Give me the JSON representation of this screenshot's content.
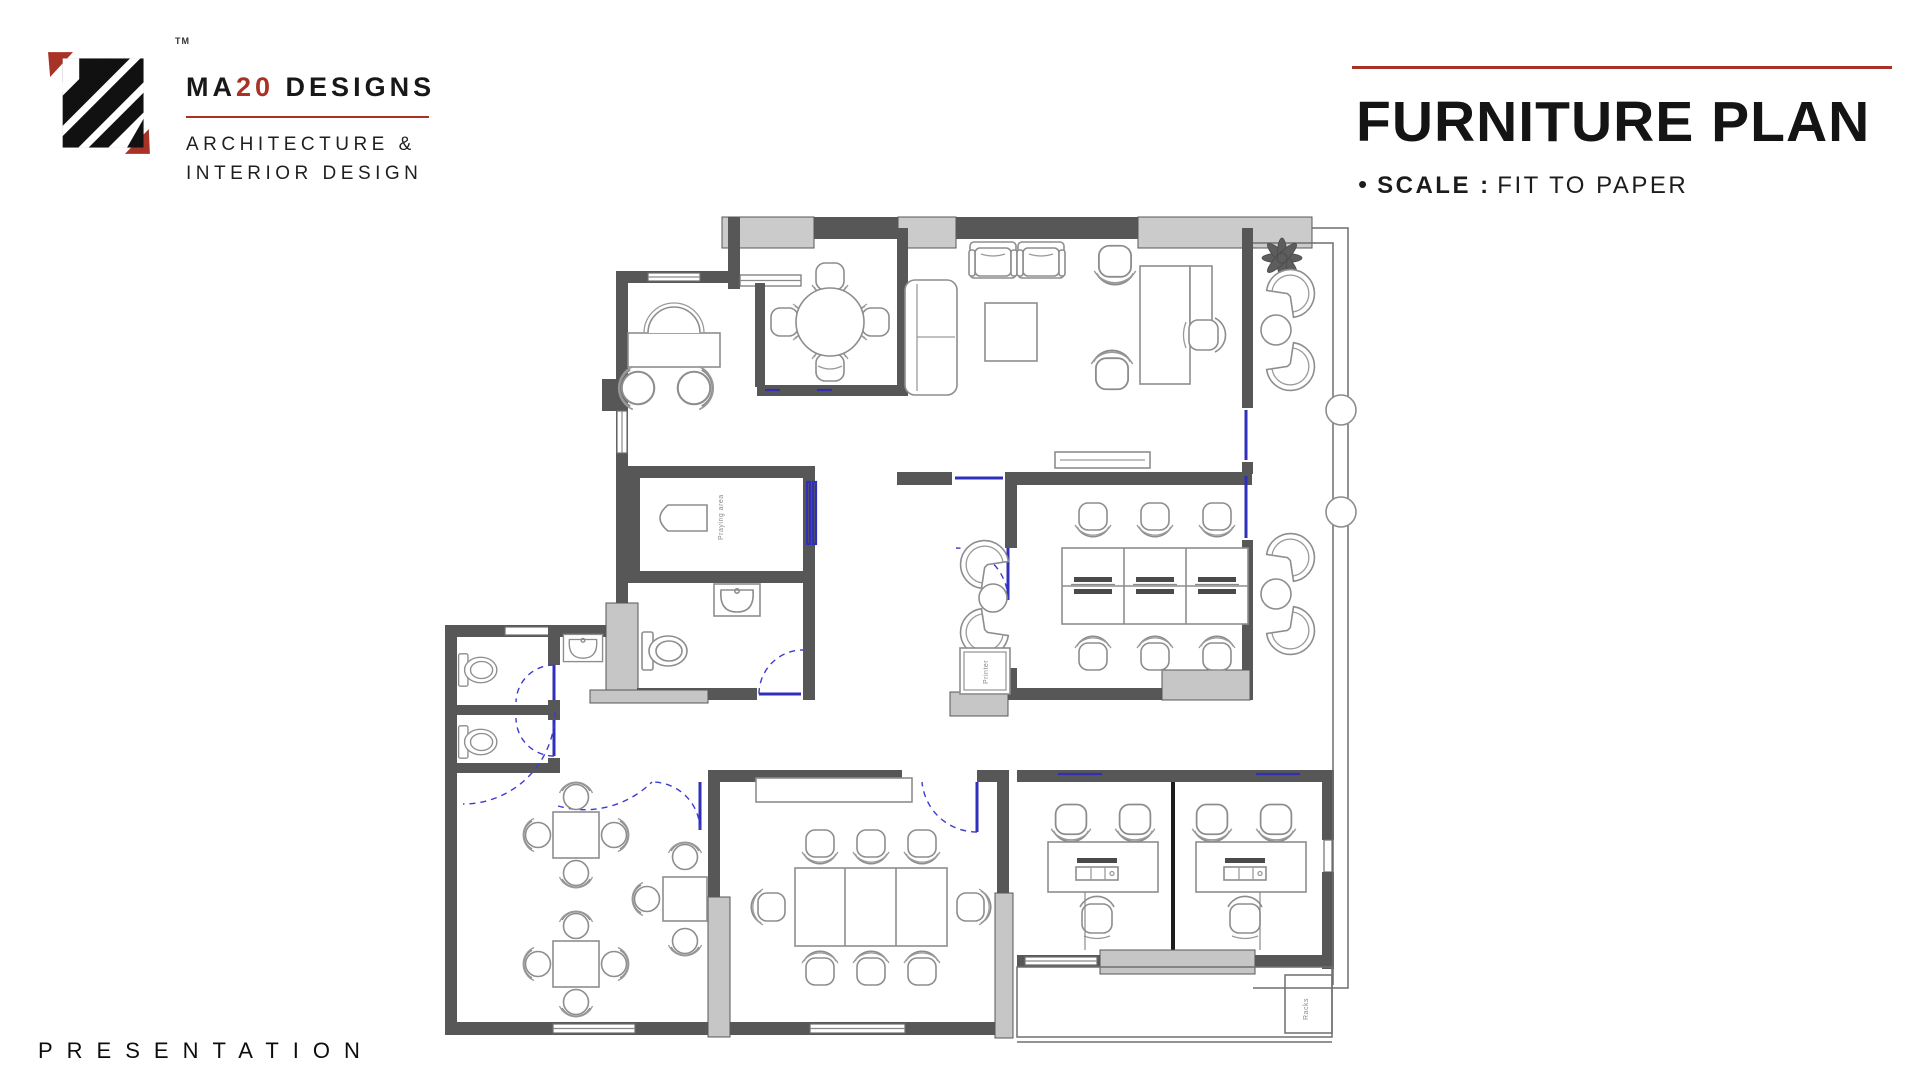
{
  "logo": {
    "trademark": "TM",
    "brand_prefix": "MA",
    "brand_number": "20",
    "brand_suffix": " DESIGNS",
    "tagline_line1": "ARCHITECTURE &",
    "tagline_line2": "INTERIOR DESIGN"
  },
  "header": {
    "title": "FURNITURE PLAN",
    "bullet": "•",
    "scale_label": "SCALE :",
    "scale_value": "FIT TO PAPER"
  },
  "footer": {
    "label": "PRESENTATION"
  },
  "plan": {
    "labels": {
      "praying_area": "Praying area",
      "printer": "Printer",
      "racks": "Racks"
    }
  },
  "colors": {
    "accent_red": "#a93226",
    "wall_gray": "#575757",
    "window_gray": "#cbcbcb",
    "door_blue": "#2f2fb8",
    "text_dark": "#141414"
  }
}
